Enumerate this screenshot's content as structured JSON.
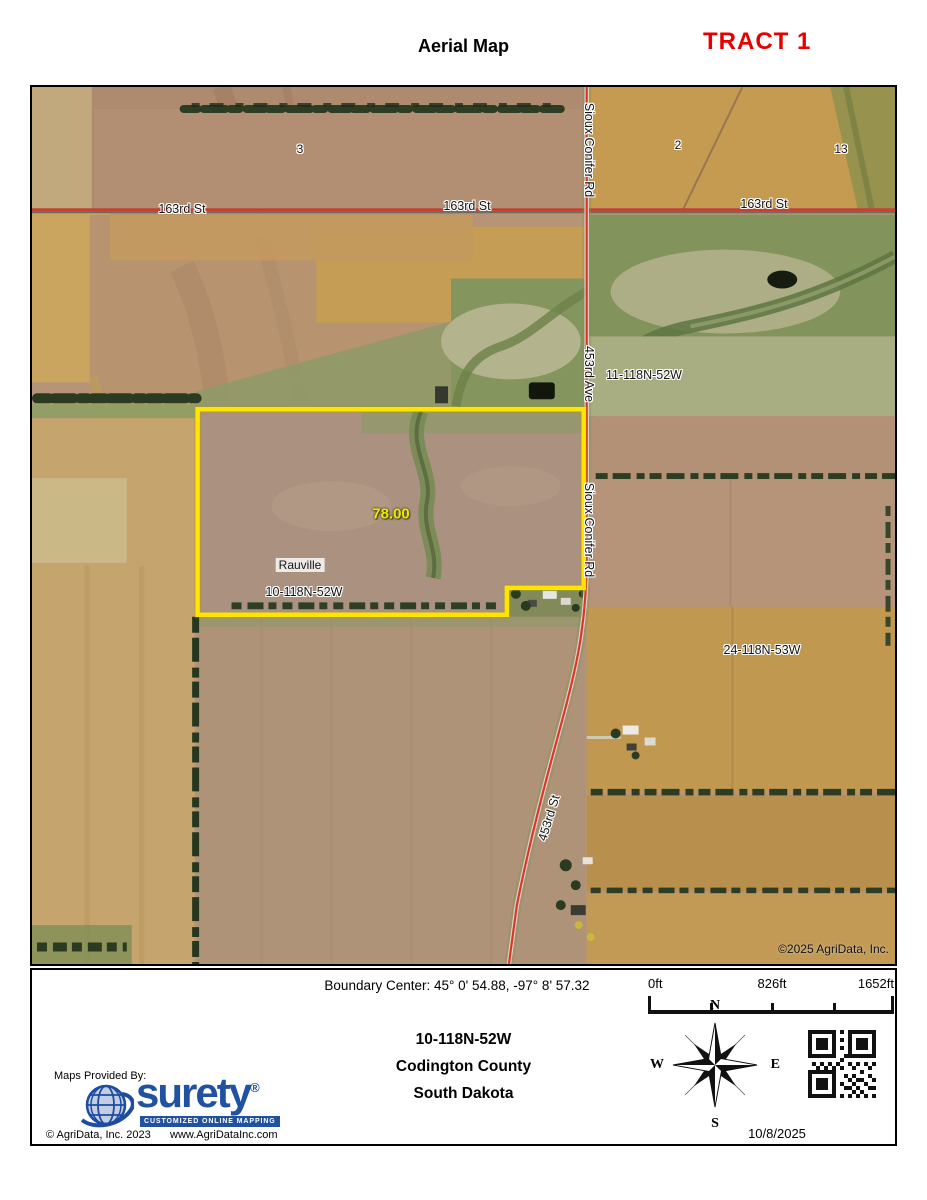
{
  "page": {
    "title": "Aerial Map",
    "tract_label": "TRACT 1"
  },
  "map": {
    "streets": {
      "s163_left": "163rd St",
      "s163_mid": "163rd St",
      "s163_right": "163rd St",
      "sioux_top": "Sioux Conifer Rd",
      "ave453": "453rd Ave",
      "sioux_mid": "Sioux Conifer Rd",
      "st453": "453rd St"
    },
    "sections": {
      "s3": "3",
      "s2": "2",
      "s13": "13"
    },
    "parcels": {
      "t11": "11-118N-52W",
      "t24": "24-118N-53W"
    },
    "tract": {
      "acres": "78.00",
      "place": "Rauville",
      "trs": "10-118N-52W"
    },
    "copyright": "©2025 AgriData, Inc."
  },
  "footer": {
    "boundary_center": "Boundary Center: 45° 0' 54.88,  -97° 8' 57.32",
    "scale": {
      "t0": "0ft",
      "t1": "826ft",
      "t2": "1652ft"
    },
    "location": {
      "trs": "10-118N-52W",
      "county": "Codington County",
      "state": "South Dakota"
    },
    "compass": {
      "n": "N",
      "e": "E",
      "s": "S",
      "w": "W"
    },
    "date": "10/8/2025",
    "provider": {
      "heading": "Maps Provided By:",
      "brand": "surety",
      "registered": "®",
      "tagline": "CUSTOMIZED ONLINE MAPPING",
      "copyright": "© AgriData, Inc. 2023",
      "website": "www.AgriDataInc.com"
    }
  },
  "colors": {
    "tract_red": "#e60000",
    "boundary_yellow": "#ffe400",
    "road_red": "#df3526",
    "brand_blue": "#2151a1"
  }
}
